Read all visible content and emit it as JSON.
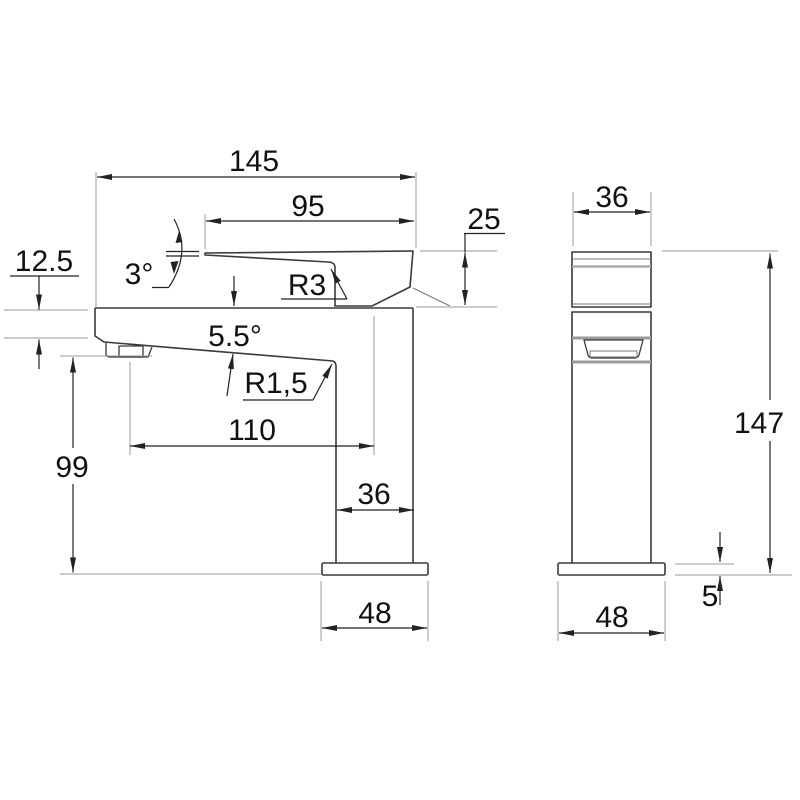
{
  "side_view": {
    "overall_length": "145",
    "spout_top_length": "95",
    "top_section_height": "25",
    "spout_tip_height": "12.5",
    "top_angle": "3°",
    "top_radius": "R3",
    "spout_angle": "5.5°",
    "spout_radius": "R1,5",
    "outlet_projection": "110",
    "outlet_height": "99",
    "body_depth": "36",
    "base_depth": "48"
  },
  "front_view": {
    "body_width": "36",
    "overall_height": "147",
    "base_thickness": "5",
    "base_width": "48"
  },
  "colors": {
    "outline": "#3a3a3a",
    "dimension": "#222222",
    "extension": "#999999",
    "text": "#111111",
    "background": "#ffffff"
  }
}
